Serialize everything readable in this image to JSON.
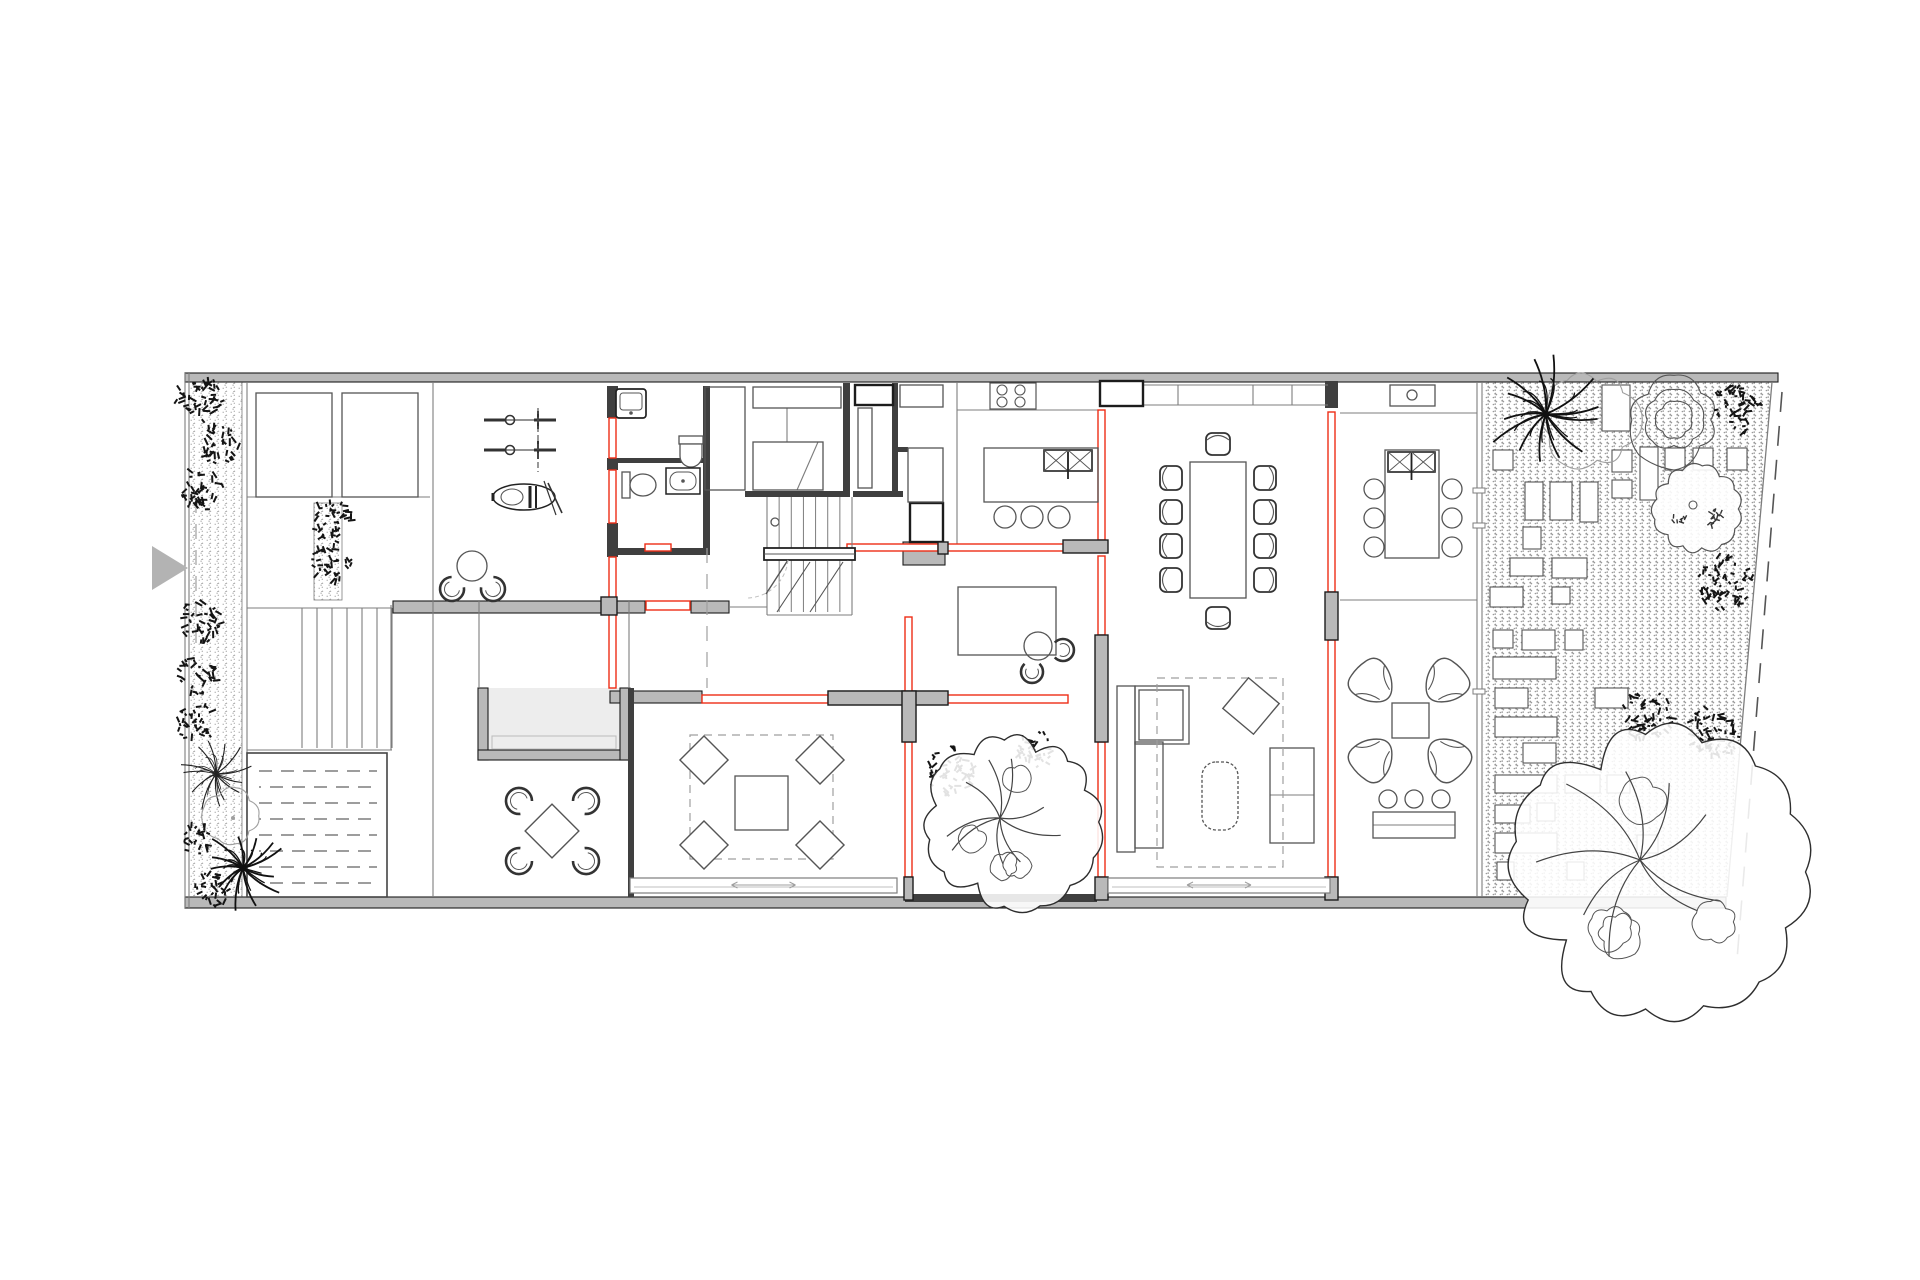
{
  "palette": {
    "bg": "#ffffff",
    "wall_gray": "#b9b9b9",
    "wall_dark": "#3f3f3f",
    "wall_edge": "#1c1c1c",
    "line": "#555555",
    "thin": "#7d7d7d",
    "light": "#9f9f9f",
    "faint": "#bfbfbf",
    "red": "#ee2d16",
    "shrub": "#141414",
    "gravel_dot": "#9a9a9a",
    "arrow": "#b3b3b3",
    "lightwell_floor": "#ededed",
    "tree_line": "#2e2e2e"
  },
  "canvas": {
    "w": 1920,
    "h": 1280
  },
  "drawing": {
    "gravel_main": [
      [
        1483,
        382
      ],
      [
        1772,
        382
      ],
      [
        1727,
        897
      ],
      [
        1483,
        897
      ]
    ],
    "gravel_strips": [
      [
        189,
        382,
        53,
        515
      ],
      [
        314,
        503,
        28,
        97
      ]
    ],
    "walls_gray": [
      [
        185,
        373,
        1593,
        9
      ],
      [
        185,
        897,
        1541,
        11
      ],
      [
        393,
        601,
        252,
        12
      ],
      [
        691,
        601,
        38,
        12
      ],
      [
        610,
        691,
        92,
        12
      ],
      [
        828,
        691,
        120,
        14
      ],
      [
        902,
        691,
        14,
        51
      ],
      [
        903,
        542,
        42,
        23
      ],
      [
        478,
        688,
        10,
        72
      ],
      [
        478,
        750,
        152,
        10
      ],
      [
        620,
        688,
        10,
        72
      ]
    ],
    "walls_dark": [
      [
        703,
        386,
        7,
        165
      ],
      [
        612,
        458,
        93,
        5
      ],
      [
        609,
        548,
        101,
        7
      ],
      [
        843,
        383,
        7,
        114
      ],
      [
        892,
        383,
        6,
        110
      ],
      [
        745,
        491,
        100,
        6
      ],
      [
        853,
        491,
        50,
        6
      ],
      [
        895,
        447,
        13,
        5
      ],
      [
        607,
        386,
        11,
        32
      ],
      [
        607,
        458,
        11,
        12
      ],
      [
        607,
        523,
        11,
        34
      ],
      [
        1325,
        381,
        13,
        27
      ],
      [
        628,
        688,
        6,
        209
      ],
      [
        905,
        894,
        192,
        8
      ]
    ],
    "gray_cols": [
      [
        828,
        691,
        120,
        14
      ],
      [
        902,
        691,
        14,
        51
      ],
      [
        1095,
        635,
        13,
        107
      ],
      [
        1063,
        540,
        45,
        13
      ],
      [
        1325,
        592,
        13,
        48
      ],
      [
        1095,
        877,
        13,
        23
      ],
      [
        1325,
        877,
        13,
        23
      ],
      [
        904,
        877,
        9,
        23
      ],
      [
        601,
        597,
        16,
        18
      ],
      [
        938,
        542,
        10,
        12
      ]
    ],
    "red_rects": [
      [
        609,
        418,
        7,
        40
      ],
      [
        609,
        470,
        7,
        53
      ],
      [
        609,
        557,
        7,
        43
      ],
      [
        609,
        612,
        7,
        76
      ],
      [
        646,
        601,
        44,
        9
      ],
      [
        645,
        544,
        26,
        7
      ],
      [
        847,
        544,
        91,
        7
      ],
      [
        947,
        544,
        118,
        7
      ],
      [
        702,
        695,
        126,
        8
      ],
      [
        947,
        695,
        121,
        8
      ],
      [
        905,
        617,
        7,
        76
      ],
      [
        905,
        742,
        7,
        135
      ],
      [
        1098,
        410,
        7,
        130
      ],
      [
        1098,
        556,
        7,
        79
      ],
      [
        1098,
        742,
        7,
        135
      ],
      [
        1328,
        412,
        7,
        180
      ],
      [
        1328,
        640,
        7,
        237
      ]
    ],
    "thin_lines": [
      [
        247,
        382,
        247,
        897
      ],
      [
        433,
        382,
        433,
        897
      ],
      [
        391,
        605,
        391,
        750
      ],
      [
        479,
        601,
        479,
        688
      ],
      [
        629,
        601,
        629,
        688
      ],
      [
        729,
        607,
        767,
        607
      ],
      [
        957,
        382,
        957,
        547
      ],
      [
        1340,
        413,
        1477,
        413
      ],
      [
        1340,
        600,
        1477,
        600
      ],
      [
        1477,
        382,
        1477,
        897
      ],
      [
        1482,
        382,
        1482,
        897
      ],
      [
        1143,
        385,
        1328,
        385
      ],
      [
        1143,
        405,
        1328,
        405
      ],
      [
        1178,
        385,
        1178,
        405
      ],
      [
        1253,
        385,
        1253,
        405
      ],
      [
        1292,
        385,
        1292,
        405
      ],
      [
        957,
        410,
        1098,
        410
      ],
      [
        247,
        608,
        392,
        608
      ],
      [
        247,
        750,
        392,
        750
      ],
      [
        302,
        608,
        302,
        748
      ],
      [
        317,
        608,
        317,
        748
      ],
      [
        332,
        608,
        332,
        748
      ],
      [
        347,
        608,
        347,
        748
      ],
      [
        362,
        608,
        362,
        748
      ],
      [
        377,
        608,
        377,
        748
      ],
      [
        392,
        608,
        392,
        748
      ],
      [
        247,
        497,
        430,
        497
      ],
      [
        787,
        408,
        787,
        442
      ],
      [
        797,
        490,
        818,
        442
      ],
      [
        185,
        373,
        185,
        908
      ],
      [
        189,
        373,
        189,
        908
      ],
      [
        1373,
        825,
        1455,
        825
      ],
      [
        1270,
        795,
        1314,
        795
      ],
      [
        1135,
        742,
        1163,
        742
      ]
    ],
    "boundary_solid": [
      1772,
      382,
      1727,
      897
    ],
    "boundary_dashed": [
      1782,
      392,
      1737,
      960
    ],
    "dashed_lines": [
      [
        196,
        498,
        196,
        650
      ],
      [
        707,
        548,
        707,
        688
      ]
    ],
    "dashed_rects": [
      [
        1157,
        678,
        126,
        189
      ],
      [
        690,
        735,
        143,
        124
      ]
    ],
    "furn_rects": [
      [
        256,
        393,
        76,
        104
      ],
      [
        342,
        393,
        76,
        104
      ],
      [
        705,
        387,
        40,
        103
      ],
      [
        753,
        387,
        88,
        21
      ],
      [
        753,
        442,
        70,
        48
      ],
      [
        858,
        408,
        14,
        80
      ],
      [
        900,
        385,
        43,
        22
      ],
      [
        908,
        448,
        35,
        54
      ],
      [
        984,
        448,
        114,
        54
      ],
      [
        1190,
        462,
        56,
        136
      ],
      [
        958,
        587,
        98,
        68
      ],
      [
        1385,
        450,
        54,
        108
      ],
      [
        1392,
        703,
        37,
        35
      ],
      [
        1373,
        812,
        82,
        26
      ],
      [
        735,
        776,
        53,
        54
      ],
      [
        1117,
        686,
        18,
        166
      ],
      [
        1135,
        742,
        28,
        106
      ],
      [
        1135,
        686,
        54,
        58
      ],
      [
        1139,
        690,
        44,
        50
      ],
      [
        1270,
        748,
        44,
        95
      ],
      [
        1390,
        385,
        45,
        21
      ]
    ],
    "light_rects": [
      [
        253,
        759,
        128,
        132
      ],
      [
        492,
        736,
        124,
        13
      ]
    ],
    "framed_rects": [
      [
        1100,
        381,
        43,
        25
      ],
      [
        855,
        385,
        38,
        20
      ],
      [
        910,
        503,
        33,
        39
      ]
    ],
    "ticks": [
      [
        1473,
        488,
        12,
        5
      ],
      [
        1473,
        523,
        12,
        5
      ],
      [
        1473,
        689,
        12,
        5
      ]
    ],
    "rot_rects": [
      [
        1251,
        706,
        40,
        40
      ],
      [
        704,
        760,
        34,
        45
      ],
      [
        820,
        760,
        34,
        45
      ],
      [
        704,
        845,
        34,
        45
      ],
      [
        820,
        845,
        34,
        45
      ],
      [
        552,
        831,
        38,
        45
      ]
    ],
    "circles": [
      [
        1005,
        517,
        11
      ],
      [
        1032,
        517,
        11
      ],
      [
        1059,
        517,
        11
      ],
      [
        1374,
        489,
        10
      ],
      [
        1374,
        518,
        10
      ],
      [
        1374,
        547,
        10
      ],
      [
        1452,
        489,
        10
      ],
      [
        1452,
        518,
        10
      ],
      [
        1452,
        547,
        10
      ],
      [
        1388,
        799,
        9
      ],
      [
        1414,
        799,
        9
      ],
      [
        1441,
        799,
        9
      ],
      [
        472,
        566,
        15
      ],
      [
        1038,
        646,
        14
      ],
      [
        1412,
        395,
        5
      ],
      [
        775,
        522,
        4
      ]
    ],
    "ring_chairs": [
      [
        452,
        589,
        12,
        -50
      ],
      [
        493,
        589,
        12,
        -130
      ],
      [
        519,
        801,
        13,
        42
      ],
      [
        586,
        801,
        13,
        138
      ],
      [
        519,
        861,
        13,
        -42
      ],
      [
        586,
        861,
        13,
        -138
      ],
      [
        1063,
        650,
        11,
        180
      ],
      [
        1032,
        672,
        11,
        -90
      ]
    ],
    "butterfly_chairs": [
      [
        1374,
        684,
        -45
      ],
      [
        1444,
        684,
        45
      ],
      [
        1374,
        757,
        -135
      ],
      [
        1446,
        757,
        135
      ]
    ],
    "dining_chairs": [
      [
        1171,
        478,
        -90
      ],
      [
        1171,
        512,
        -90
      ],
      [
        1171,
        546,
        -90
      ],
      [
        1171,
        580,
        -90
      ],
      [
        1265,
        478,
        90
      ],
      [
        1265,
        512,
        90
      ],
      [
        1265,
        546,
        90
      ],
      [
        1265,
        580,
        90
      ],
      [
        1218,
        444,
        0
      ],
      [
        1218,
        618,
        180
      ]
    ],
    "sinks": [
      [
        1044,
        450,
        48,
        21
      ],
      [
        1388,
        452,
        47,
        20
      ]
    ],
    "stove": {
      "x": 990,
      "y": 383,
      "w": 46,
      "h": 26
    },
    "pool": {
      "x": 247,
      "y": 753,
      "w": 140,
      "h": 144
    },
    "stairs_main": {
      "x": 767,
      "y": 497,
      "w": 85,
      "landing_y": 548,
      "landing_h": 12,
      "bottom": 615,
      "diagonals": [
        [
          777,
          612,
          810,
          562
        ],
        [
          810,
          612,
          843,
          562
        ]
      ],
      "door_leaf": [
        788,
        560,
        766,
        594
      ]
    },
    "ottoman": {
      "x": 1202,
      "y": 762,
      "w": 36,
      "h": 68,
      "rx": 14
    },
    "sliding_doors": [
      [
        630,
        878,
        267
      ],
      [
        1108,
        878,
        222
      ]
    ],
    "pavers": [
      [
        1493,
        450,
        20,
        20
      ],
      [
        1525,
        482,
        18,
        38
      ],
      [
        1550,
        482,
        22,
        38
      ],
      [
        1580,
        482,
        18,
        40
      ],
      [
        1523,
        527,
        18,
        22
      ],
      [
        1510,
        558,
        33,
        18
      ],
      [
        1552,
        558,
        35,
        20
      ],
      [
        1490,
        587,
        33,
        20
      ],
      [
        1552,
        587,
        18,
        17
      ],
      [
        1612,
        450,
        20,
        22
      ],
      [
        1612,
        480,
        20,
        18
      ],
      [
        1640,
        447,
        18,
        53
      ],
      [
        1665,
        448,
        20,
        22
      ],
      [
        1693,
        448,
        20,
        22
      ],
      [
        1727,
        448,
        20,
        22
      ],
      [
        1602,
        385,
        28,
        46
      ],
      [
        1493,
        630,
        20,
        18
      ],
      [
        1522,
        630,
        33,
        20
      ],
      [
        1565,
        630,
        18,
        20
      ],
      [
        1493,
        657,
        63,
        22
      ],
      [
        1495,
        688,
        33,
        20
      ],
      [
        1595,
        688,
        33,
        20
      ],
      [
        1495,
        717,
        62,
        20
      ],
      [
        1523,
        743,
        33,
        20
      ],
      [
        1495,
        775,
        62,
        18
      ],
      [
        1565,
        775,
        35,
        18
      ],
      [
        1607,
        775,
        23,
        18
      ],
      [
        1495,
        805,
        35,
        18
      ],
      [
        1537,
        803,
        18,
        18
      ],
      [
        1495,
        833,
        62,
        20
      ],
      [
        1497,
        862,
        17,
        18
      ],
      [
        1567,
        862,
        17,
        18
      ],
      [
        1637,
        835,
        21,
        18
      ]
    ],
    "bikes": [
      [
        520,
        420
      ],
      [
        520,
        450
      ]
    ],
    "bike_rack": [
      538,
      408,
      538,
      472
    ],
    "moto": {
      "x": 524,
      "y": 497
    },
    "fixtures": {
      "laundry": [
        616,
        389,
        30,
        29
      ],
      "toilet_up": [
        691,
        450
      ],
      "toilet_left": [
        622,
        472
      ],
      "washbasin": [
        666,
        468,
        34,
        26
      ]
    },
    "entry_arrow": [
      [
        152,
        546
      ],
      [
        152,
        590
      ],
      [
        188,
        568
      ]
    ],
    "trees": [
      {
        "t": "shrub",
        "x": 199,
        "y": 399,
        "r": 25,
        "s": 1
      },
      {
        "t": "shrub",
        "x": 219,
        "y": 443,
        "r": 22,
        "s": 2
      },
      {
        "t": "shrub",
        "x": 201,
        "y": 489,
        "r": 23,
        "s": 3
      },
      {
        "t": "shrub",
        "x": 200,
        "y": 621,
        "r": 23,
        "s": 4
      },
      {
        "t": "shrub",
        "x": 198,
        "y": 675,
        "r": 21,
        "s": 5
      },
      {
        "t": "shrub",
        "x": 197,
        "y": 723,
        "r": 21,
        "s": 6
      },
      {
        "t": "fern",
        "x": 216,
        "y": 774,
        "r": 36,
        "s": 7
      },
      {
        "t": "blob",
        "x": 231,
        "y": 816,
        "r": 26,
        "s": 8
      },
      {
        "t": "shrub",
        "x": 198,
        "y": 838,
        "r": 18,
        "s": 9
      },
      {
        "t": "palm",
        "x": 243,
        "y": 868,
        "r": 40,
        "s": 10
      },
      {
        "t": "shrub",
        "x": 213,
        "y": 888,
        "r": 20,
        "s": 11
      },
      {
        "t": "shrub",
        "x": 331,
        "y": 520,
        "r": 22,
        "s": 12
      },
      {
        "t": "shrub",
        "x": 332,
        "y": 562,
        "r": 22,
        "s": 13
      },
      {
        "t": "shrub",
        "x": 951,
        "y": 771,
        "r": 26,
        "s": 16
      },
      {
        "t": "shrub",
        "x": 1035,
        "y": 749,
        "r": 21,
        "s": 17
      },
      {
        "t": "canopy",
        "x": 1013,
        "y": 822,
        "r": 80,
        "tx": 1000,
        "ty": 818,
        "s": 18
      },
      {
        "t": "blob",
        "x": 1590,
        "y": 420,
        "r": 46,
        "s": 19
      },
      {
        "t": "palm",
        "x": 1546,
        "y": 414,
        "r": 56,
        "s": 20
      },
      {
        "t": "agave",
        "x": 1674,
        "y": 420,
        "r": 42,
        "s": 21
      },
      {
        "t": "shrub",
        "x": 1736,
        "y": 409,
        "r": 27,
        "s": 22
      },
      {
        "t": "round",
        "x": 1697,
        "y": 509,
        "r": 41,
        "s": 23
      },
      {
        "t": "shrub",
        "x": 1726,
        "y": 583,
        "r": 30,
        "s": 24
      },
      {
        "t": "shrub",
        "x": 1648,
        "y": 716,
        "r": 27,
        "s": 25
      },
      {
        "t": "shrub",
        "x": 1713,
        "y": 733,
        "r": 28,
        "s": 26
      },
      {
        "t": "canopy",
        "x": 1660,
        "y": 872,
        "r": 135,
        "tx": 1640,
        "ty": 860,
        "s": 27
      }
    ]
  }
}
